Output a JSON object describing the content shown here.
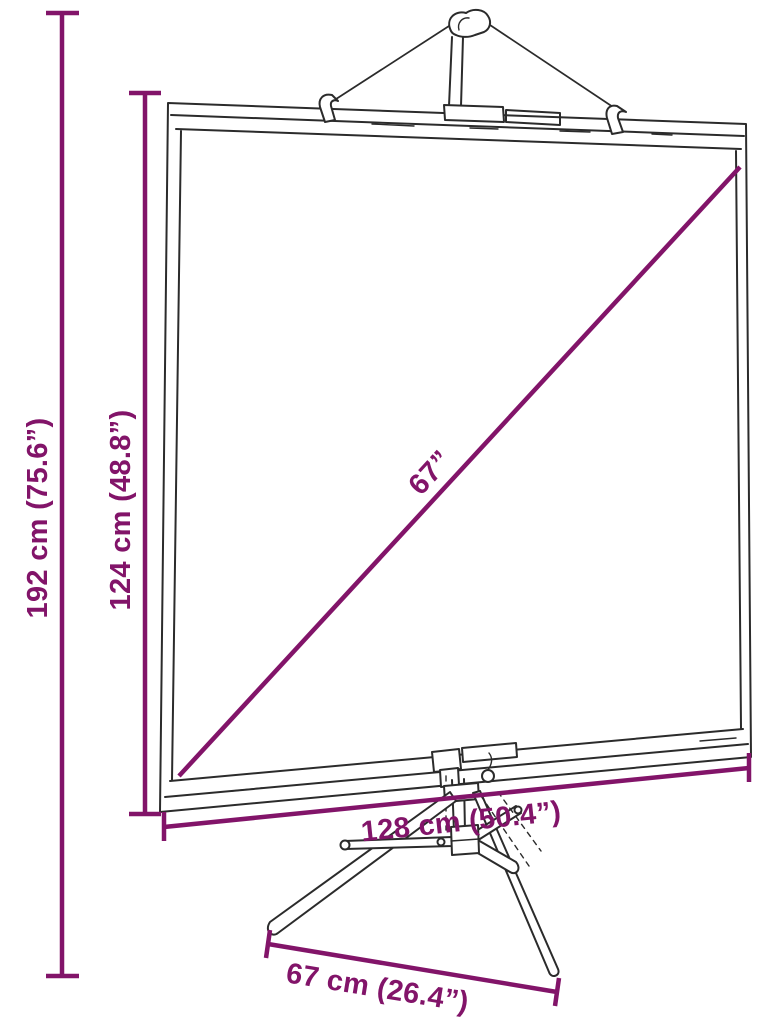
{
  "diagram": {
    "colors": {
      "accent": "#821469",
      "ink": "#2b2b2b",
      "background": "#ffffff"
    },
    "dimensions": {
      "total_height": "192 cm (75.6”)",
      "screen_height": "124 cm (48.8”)",
      "diagonal": "67”",
      "screen_width": "128 cm (50.4”)",
      "base_depth": "67 cm (26.4”)"
    }
  }
}
